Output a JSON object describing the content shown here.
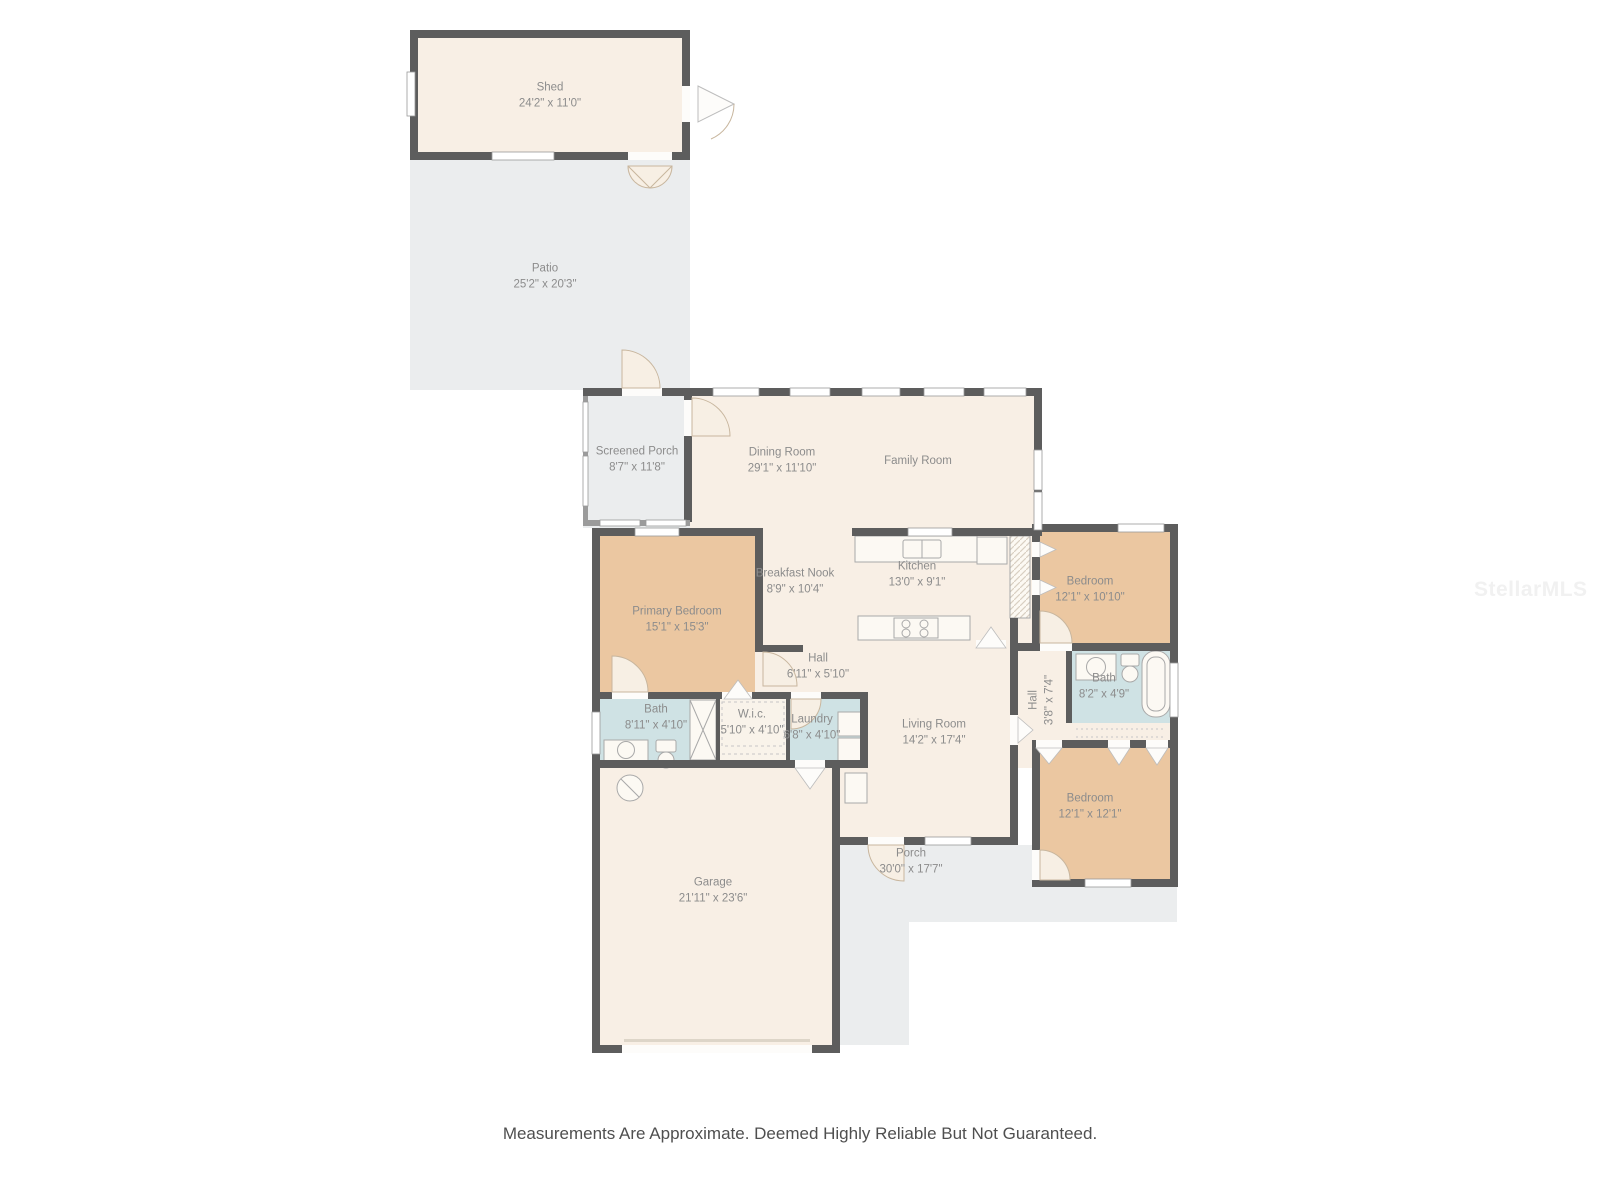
{
  "watermark": "StellarMLS",
  "footer": {
    "disclaimer": "Measurements Are Approximate. Deemed Highly Reliable But Not Guaranteed."
  },
  "colors": {
    "wall": "#5d5d5d",
    "room": "#f8efe5",
    "bedroom": "#ebc7a1",
    "bath": "#cfe2e4",
    "outdoor": "#ebedee",
    "label": "#8c8c8c"
  },
  "rooms": [
    {
      "name": "Shed",
      "dims": "24'2\" x 11'0\""
    },
    {
      "name": "Patio",
      "dims": "25'2\" x 20'3\""
    },
    {
      "name": "Screened Porch",
      "dims": "8'7\" x 11'8\""
    },
    {
      "name": "Dining Room",
      "dims": "29'1\" x 11'10\""
    },
    {
      "name": "Family Room",
      "dims": ""
    },
    {
      "name": "Breakfast Nook",
      "dims": "8'9\" x 10'4\""
    },
    {
      "name": "Kitchen",
      "dims": "13'0\" x 9'1\""
    },
    {
      "name": "Primary Bedroom",
      "dims": "15'1\" x 15'3\""
    },
    {
      "name": "Bedroom",
      "dims": "12'1\" x 10'10\""
    },
    {
      "name": "Hall",
      "dims": "6'11\" x 5'10\""
    },
    {
      "name": "Hall",
      "dims": "3'8\" x 7'4\""
    },
    {
      "name": "Bath",
      "dims": "8'2\" x 4'9\""
    },
    {
      "name": "Bath",
      "dims": "8'11\" x 4'10\""
    },
    {
      "name": "W.i.c.",
      "dims": "5'10\" x 4'10\""
    },
    {
      "name": "Laundry",
      "dims": "6'8\" x 4'10\""
    },
    {
      "name": "Living Room",
      "dims": "14'2\" x 17'4\""
    },
    {
      "name": "Bedroom",
      "dims": "12'1\" x 12'1\""
    },
    {
      "name": "Garage",
      "dims": "21'11\" x 23'6\""
    },
    {
      "name": "Porch",
      "dims": "30'0\" x 17'7\""
    }
  ]
}
